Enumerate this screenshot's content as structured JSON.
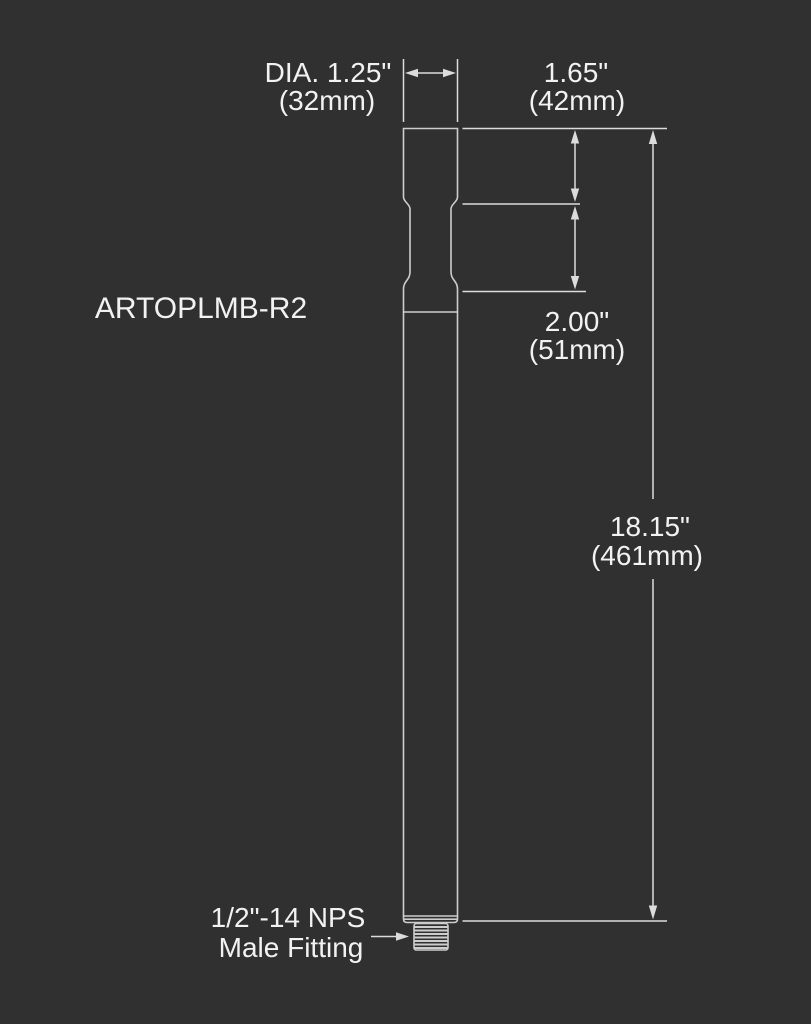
{
  "colors": {
    "background": "#303030",
    "outline": "#cdcdcd",
    "dimension": "#dcdcdc",
    "text": "#f2f2f2"
  },
  "part": {
    "model": "ARTOPLMB-R2"
  },
  "labels": {
    "diameter": {
      "line1": "DIA. 1.25\"",
      "line2": "(32mm)"
    },
    "top_section": {
      "line1": "1.65\"",
      "line2": "(42mm)"
    },
    "groove_section": {
      "line1": "2.00\"",
      "line2": "(51mm)"
    },
    "overall_length": {
      "line1": "18.15\"",
      "line2": "(461mm)"
    },
    "fitting": {
      "line1": "1/2\"-14 NPS",
      "line2": "Male Fitting"
    }
  }
}
